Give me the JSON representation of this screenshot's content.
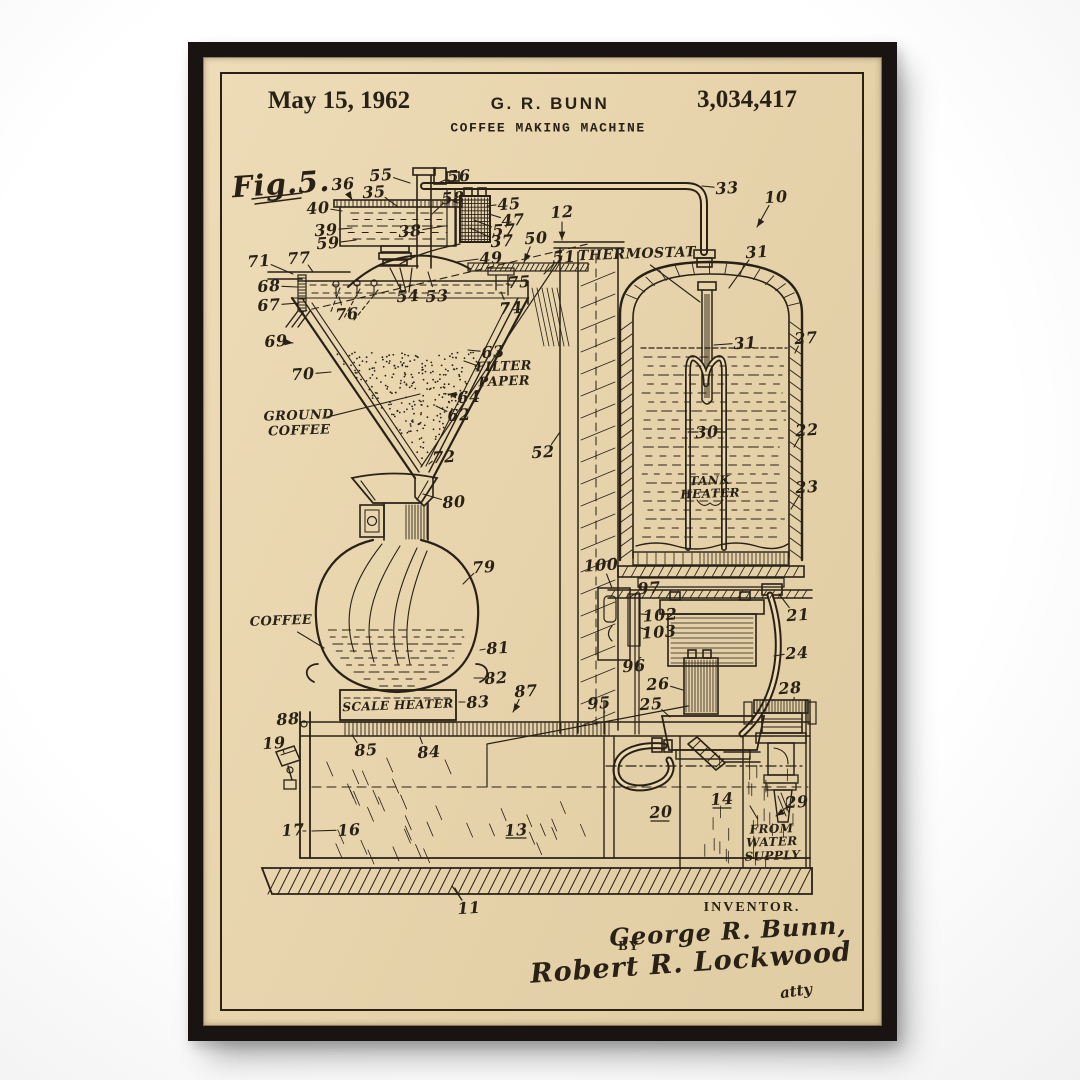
{
  "poster": {
    "frame_color": "#191411",
    "paper_color": "#ecd9b1",
    "ink_color": "#2a2116"
  },
  "header": {
    "date": "May 15, 1962",
    "inventor_name": "G. R. BUNN",
    "patent_number": "3,034,417",
    "title": "COFFEE MAKING MACHINE"
  },
  "figure": {
    "label": "Fig.5."
  },
  "diagram": {
    "text_labels": [
      {
        "text": "THERMOSTAT",
        "x": 637,
        "y": 255,
        "size": 14,
        "tx": 700,
        "ty": 302
      },
      {
        "text": "FILTER\nPAPER",
        "x": 504,
        "y": 375,
        "size": 13,
        "tx": 464,
        "ty": 361
      },
      {
        "text": "GROUND\nCOFFEE",
        "x": 299,
        "y": 424,
        "size": 13,
        "tx": 420,
        "ty": 394
      },
      {
        "text": "COFFEE",
        "x": 281,
        "y": 622,
        "size": 13,
        "tx": 324,
        "ty": 648
      },
      {
        "text": "SCALE HEATER",
        "x": 398,
        "y": 706,
        "size": 12,
        "tx": null,
        "ty": null
      },
      {
        "text": "TANK\nHEATER",
        "x": 710,
        "y": 488,
        "size": 12,
        "tx": null,
        "ty": null
      },
      {
        "text": "FROM\nWATER\nSUPPLY",
        "x": 772,
        "y": 843,
        "size": 12,
        "tx": 750,
        "ty": 806
      }
    ],
    "part_numbers": [
      {
        "n": "36",
        "x": 343,
        "y": 184,
        "tx": 352,
        "ty": 200,
        "arrow": true
      },
      {
        "n": "55",
        "x": 381,
        "y": 175,
        "tx": 410,
        "ty": 183,
        "arrow": false
      },
      {
        "n": "56",
        "x": 459,
        "y": 176,
        "tx": 436,
        "ty": 184,
        "arrow": false
      },
      {
        "n": "35",
        "x": 374,
        "y": 192,
        "tx": 398,
        "ty": 207,
        "arrow": false
      },
      {
        "n": "58",
        "x": 453,
        "y": 198,
        "tx": 432,
        "ty": 214,
        "arrow": false
      },
      {
        "n": "40",
        "x": 318,
        "y": 208,
        "tx": 342,
        "ty": 211,
        "arrow": false
      },
      {
        "n": "39",
        "x": 326,
        "y": 230,
        "tx": 352,
        "ty": 228,
        "arrow": false
      },
      {
        "n": "59",
        "x": 328,
        "y": 243,
        "tx": 356,
        "ty": 240,
        "arrow": false
      },
      {
        "n": "38",
        "x": 410,
        "y": 231,
        "tx": 444,
        "ty": 226,
        "arrow": false
      },
      {
        "n": "45",
        "x": 509,
        "y": 204,
        "tx": 487,
        "ty": 206,
        "arrow": false
      },
      {
        "n": "47",
        "x": 513,
        "y": 220,
        "tx": 489,
        "ty": 214,
        "arrow": false
      },
      {
        "n": "57",
        "x": 504,
        "y": 230,
        "tx": 474,
        "ty": 220,
        "arrow": false
      },
      {
        "n": "37",
        "x": 502,
        "y": 241,
        "tx": 470,
        "ty": 228,
        "arrow": false
      },
      {
        "n": "49",
        "x": 491,
        "y": 258,
        "tx": 456,
        "ty": 262,
        "arrow": false
      },
      {
        "n": "50",
        "x": 536,
        "y": 238,
        "tx": 524,
        "ty": 262,
        "arrow": true
      },
      {
        "n": "12",
        "x": 562,
        "y": 212,
        "tx": 562,
        "ty": 240,
        "arrow": true
      },
      {
        "n": "51",
        "x": 564,
        "y": 257,
        "tx": 544,
        "ty": 274,
        "arrow": false
      },
      {
        "n": "33",
        "x": 727,
        "y": 188,
        "tx": 702,
        "ty": 186,
        "arrow": false
      },
      {
        "n": "10",
        "x": 776,
        "y": 197,
        "tx": 757,
        "ty": 227,
        "arrow": true
      },
      {
        "n": "31",
        "x": 757,
        "y": 252,
        "tx": 729,
        "ty": 288,
        "arrow": false
      },
      {
        "n": "31",
        "x": 745,
        "y": 343,
        "tx": 714,
        "ty": 345,
        "arrow": false
      },
      {
        "n": "27",
        "x": 806,
        "y": 338,
        "tx": 795,
        "ty": 353,
        "arrow": false
      },
      {
        "n": "30",
        "x": 707,
        "y": 432,
        "tx": null,
        "ty": null,
        "arrow": false
      },
      {
        "n": "22",
        "x": 807,
        "y": 430,
        "tx": 794,
        "ty": 447,
        "arrow": false
      },
      {
        "n": "23",
        "x": 807,
        "y": 487,
        "tx": 791,
        "ty": 509,
        "arrow": false
      },
      {
        "n": "71",
        "x": 259,
        "y": 261,
        "tx": 293,
        "ty": 274,
        "arrow": false
      },
      {
        "n": "77",
        "x": 299,
        "y": 258,
        "tx": 313,
        "ty": 272,
        "arrow": false
      },
      {
        "n": "68",
        "x": 269,
        "y": 286,
        "tx": 297,
        "ty": 287,
        "arrow": false
      },
      {
        "n": "67",
        "x": 269,
        "y": 305,
        "tx": 299,
        "ty": 303,
        "arrow": false
      },
      {
        "n": "75",
        "x": 519,
        "y": 282,
        "tx": 509,
        "ty": 284,
        "arrow": false
      },
      {
        "n": "74",
        "x": 511,
        "y": 308,
        "tx": 501,
        "ty": 292,
        "arrow": false
      },
      {
        "n": "76",
        "x": 347,
        "y": 314,
        "tx": 339,
        "ty": 297,
        "arrow": false
      },
      {
        "n": "54",
        "x": 408,
        "y": 296,
        "tx": 400,
        "ty": 284,
        "arrow": false
      },
      {
        "n": "53",
        "x": 437,
        "y": 296,
        "tx": 428,
        "ty": 272,
        "arrow": false
      },
      {
        "n": "69",
        "x": 276,
        "y": 341,
        "tx": 293,
        "ty": 343,
        "arrow": true
      },
      {
        "n": "70",
        "x": 303,
        "y": 374,
        "tx": 331,
        "ty": 372,
        "arrow": false
      },
      {
        "n": "63",
        "x": 493,
        "y": 352,
        "tx": 468,
        "ty": 350,
        "arrow": false
      },
      {
        "n": "64",
        "x": 469,
        "y": 397,
        "tx": 448,
        "ty": 394,
        "arrow": true
      },
      {
        "n": "62",
        "x": 459,
        "y": 415,
        "tx": 436,
        "ty": 406,
        "arrow": false
      },
      {
        "n": "72",
        "x": 444,
        "y": 457,
        "tx": 429,
        "ty": 464,
        "arrow": false
      },
      {
        "n": "52",
        "x": 543,
        "y": 452,
        "tx": 560,
        "ty": 432,
        "arrow": false
      },
      {
        "n": "80",
        "x": 454,
        "y": 502,
        "tx": 423,
        "ty": 494,
        "arrow": false
      },
      {
        "n": "79",
        "x": 484,
        "y": 567,
        "tx": 463,
        "ty": 584,
        "arrow": false
      },
      {
        "n": "81",
        "x": 498,
        "y": 648,
        "tx": 480,
        "ty": 650,
        "arrow": false
      },
      {
        "n": "82",
        "x": 496,
        "y": 678,
        "tx": 474,
        "ty": 678,
        "arrow": false
      },
      {
        "n": "83",
        "x": 478,
        "y": 702,
        "tx": 459,
        "ty": 702,
        "arrow": false
      },
      {
        "n": "87",
        "x": 526,
        "y": 691,
        "tx": 513,
        "ty": 712,
        "arrow": true
      },
      {
        "n": "100",
        "x": 601,
        "y": 565,
        "tx": 612,
        "ty": 588,
        "arrow": false
      },
      {
        "n": "97",
        "x": 649,
        "y": 588,
        "tx": 630,
        "ty": 597,
        "arrow": false
      },
      {
        "n": "102",
        "x": 660,
        "y": 615,
        "tx": 641,
        "ty": 614,
        "arrow": false
      },
      {
        "n": "103",
        "x": 659,
        "y": 632,
        "tx": 641,
        "ty": 628,
        "arrow": false
      },
      {
        "n": "96",
        "x": 634,
        "y": 666,
        "tx": 639,
        "ty": 658,
        "arrow": false
      },
      {
        "n": "26",
        "x": 658,
        "y": 684,
        "tx": 683,
        "ty": 690,
        "arrow": false
      },
      {
        "n": "25",
        "x": 651,
        "y": 704,
        "tx": 670,
        "ty": 717,
        "arrow": false
      },
      {
        "n": "95",
        "x": 599,
        "y": 703,
        "tx": 604,
        "ty": 713,
        "arrow": false
      },
      {
        "n": "21",
        "x": 798,
        "y": 615,
        "tx": 779,
        "ty": 594,
        "arrow": false
      },
      {
        "n": "24",
        "x": 797,
        "y": 653,
        "tx": 774,
        "ty": 656,
        "arrow": false
      },
      {
        "n": "28",
        "x": 790,
        "y": 688,
        "tx": 794,
        "ty": 700,
        "arrow": false
      },
      {
        "n": "88",
        "x": 288,
        "y": 719,
        "tx": 301,
        "ty": 723,
        "arrow": false
      },
      {
        "n": "19",
        "x": 274,
        "y": 743,
        "tx": 284,
        "ty": 753,
        "arrow": false
      },
      {
        "n": "85",
        "x": 366,
        "y": 750,
        "tx": 352,
        "ty": 735,
        "arrow": false
      },
      {
        "n": "84",
        "x": 429,
        "y": 752,
        "tx": 420,
        "ty": 737,
        "arrow": false
      },
      {
        "n": "17",
        "x": 293,
        "y": 830,
        "tx": 303,
        "ty": 831,
        "arrow": false
      },
      {
        "n": "16",
        "x": 349,
        "y": 830,
        "tx": 312,
        "ty": 831,
        "arrow": false
      },
      {
        "n": "13",
        "x": 516,
        "y": 830,
        "tx": null,
        "ty": null,
        "arrow": false
      },
      {
        "n": "20",
        "x": 661,
        "y": 812,
        "tx": null,
        "ty": null,
        "arrow": false
      },
      {
        "n": "14",
        "x": 722,
        "y": 799,
        "tx": null,
        "ty": null,
        "arrow": false
      },
      {
        "n": "29",
        "x": 797,
        "y": 802,
        "tx": 776,
        "ty": 816,
        "arrow": true
      },
      {
        "n": "11",
        "x": 469,
        "y": 908,
        "tx": 455,
        "ty": 888,
        "arrow": false
      }
    ]
  },
  "footer": {
    "inventor_caption": "INVENTOR.",
    "inventor_signature": "George R. Bunn,",
    "by_label": "BY",
    "attorney_signature": "Robert R. Lockwood",
    "attorney_note": "atty"
  }
}
